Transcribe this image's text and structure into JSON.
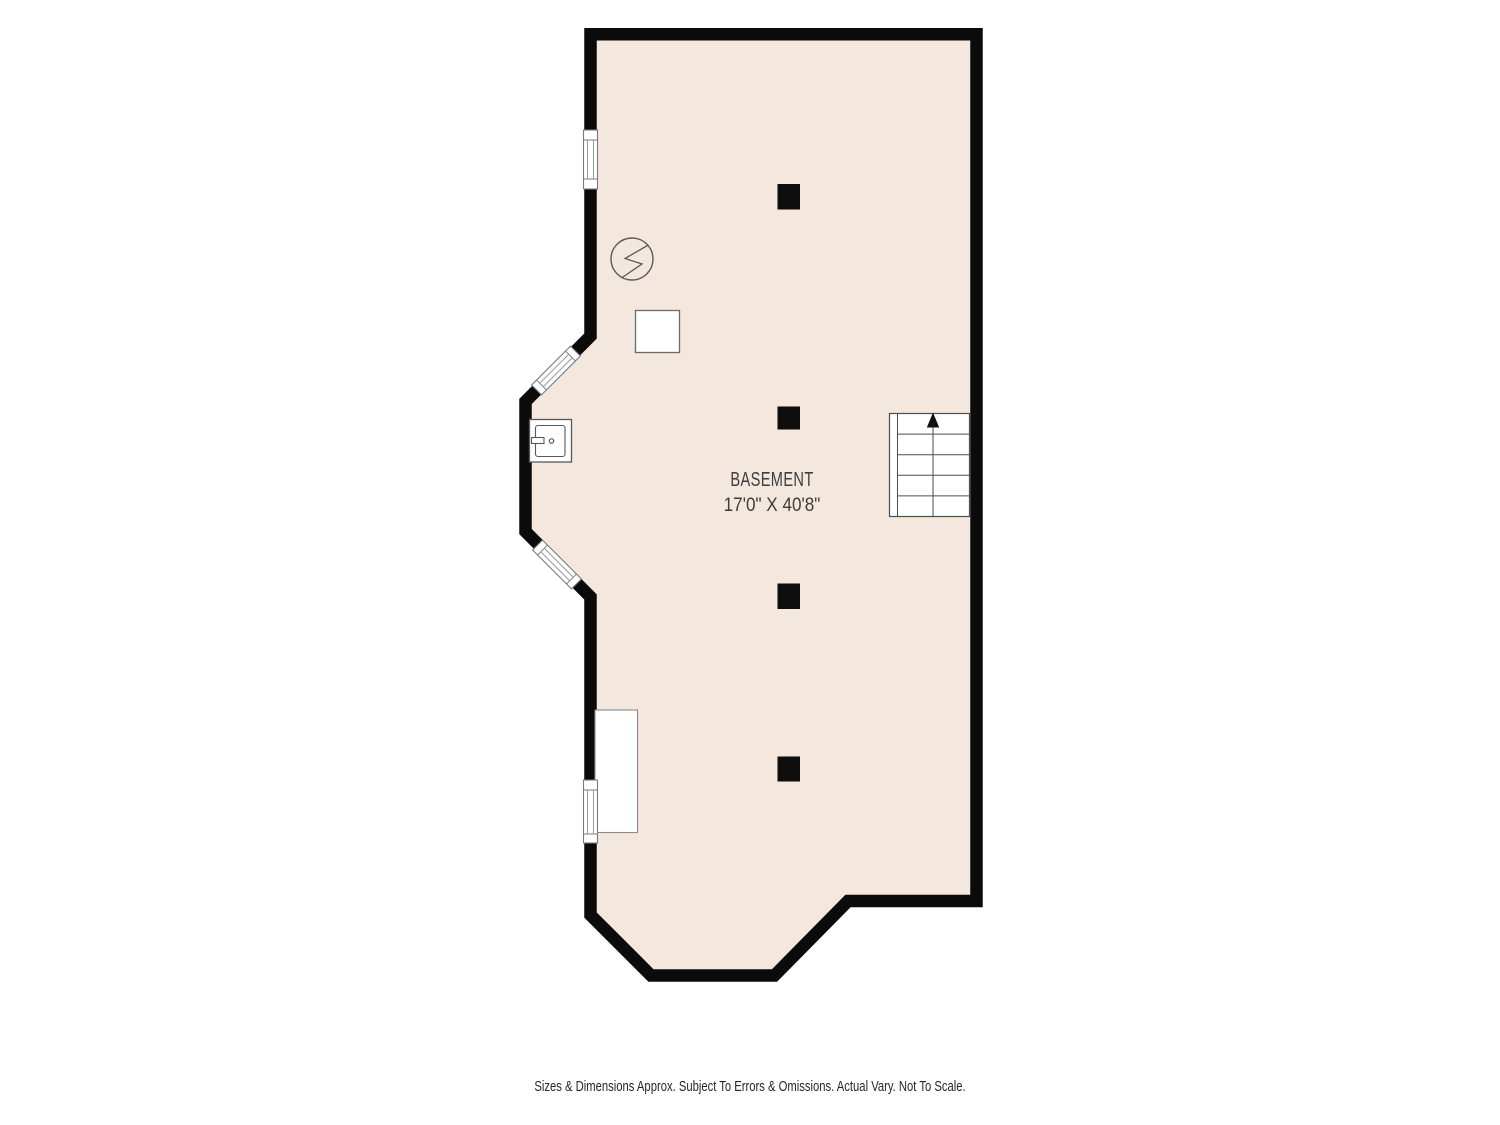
{
  "plan": {
    "room": {
      "name": "BASEMENT",
      "dimensions": "17'0\" X 40'8\""
    },
    "colors": {
      "floor_fill": "#f3e7de",
      "wall": "#0b0b0b",
      "fixture_stroke": "#5c5c5c",
      "label_text": "#3d3d3d"
    },
    "fixtures": [
      {
        "name": "electrical-meter",
        "icon": "circle-lightning-icon"
      },
      {
        "name": "furnace-unit"
      },
      {
        "name": "utility-sink"
      },
      {
        "name": "storage-area"
      },
      {
        "name": "staircase",
        "direction": "up",
        "treads": 5
      },
      {
        "name": "support-post",
        "count": 4
      },
      {
        "name": "window",
        "count": 4
      }
    ]
  },
  "footer": {
    "disclaimer": "Sizes & Dimensions Approx. Subject To Errors & Omissions. Actual Vary. Not To Scale."
  }
}
